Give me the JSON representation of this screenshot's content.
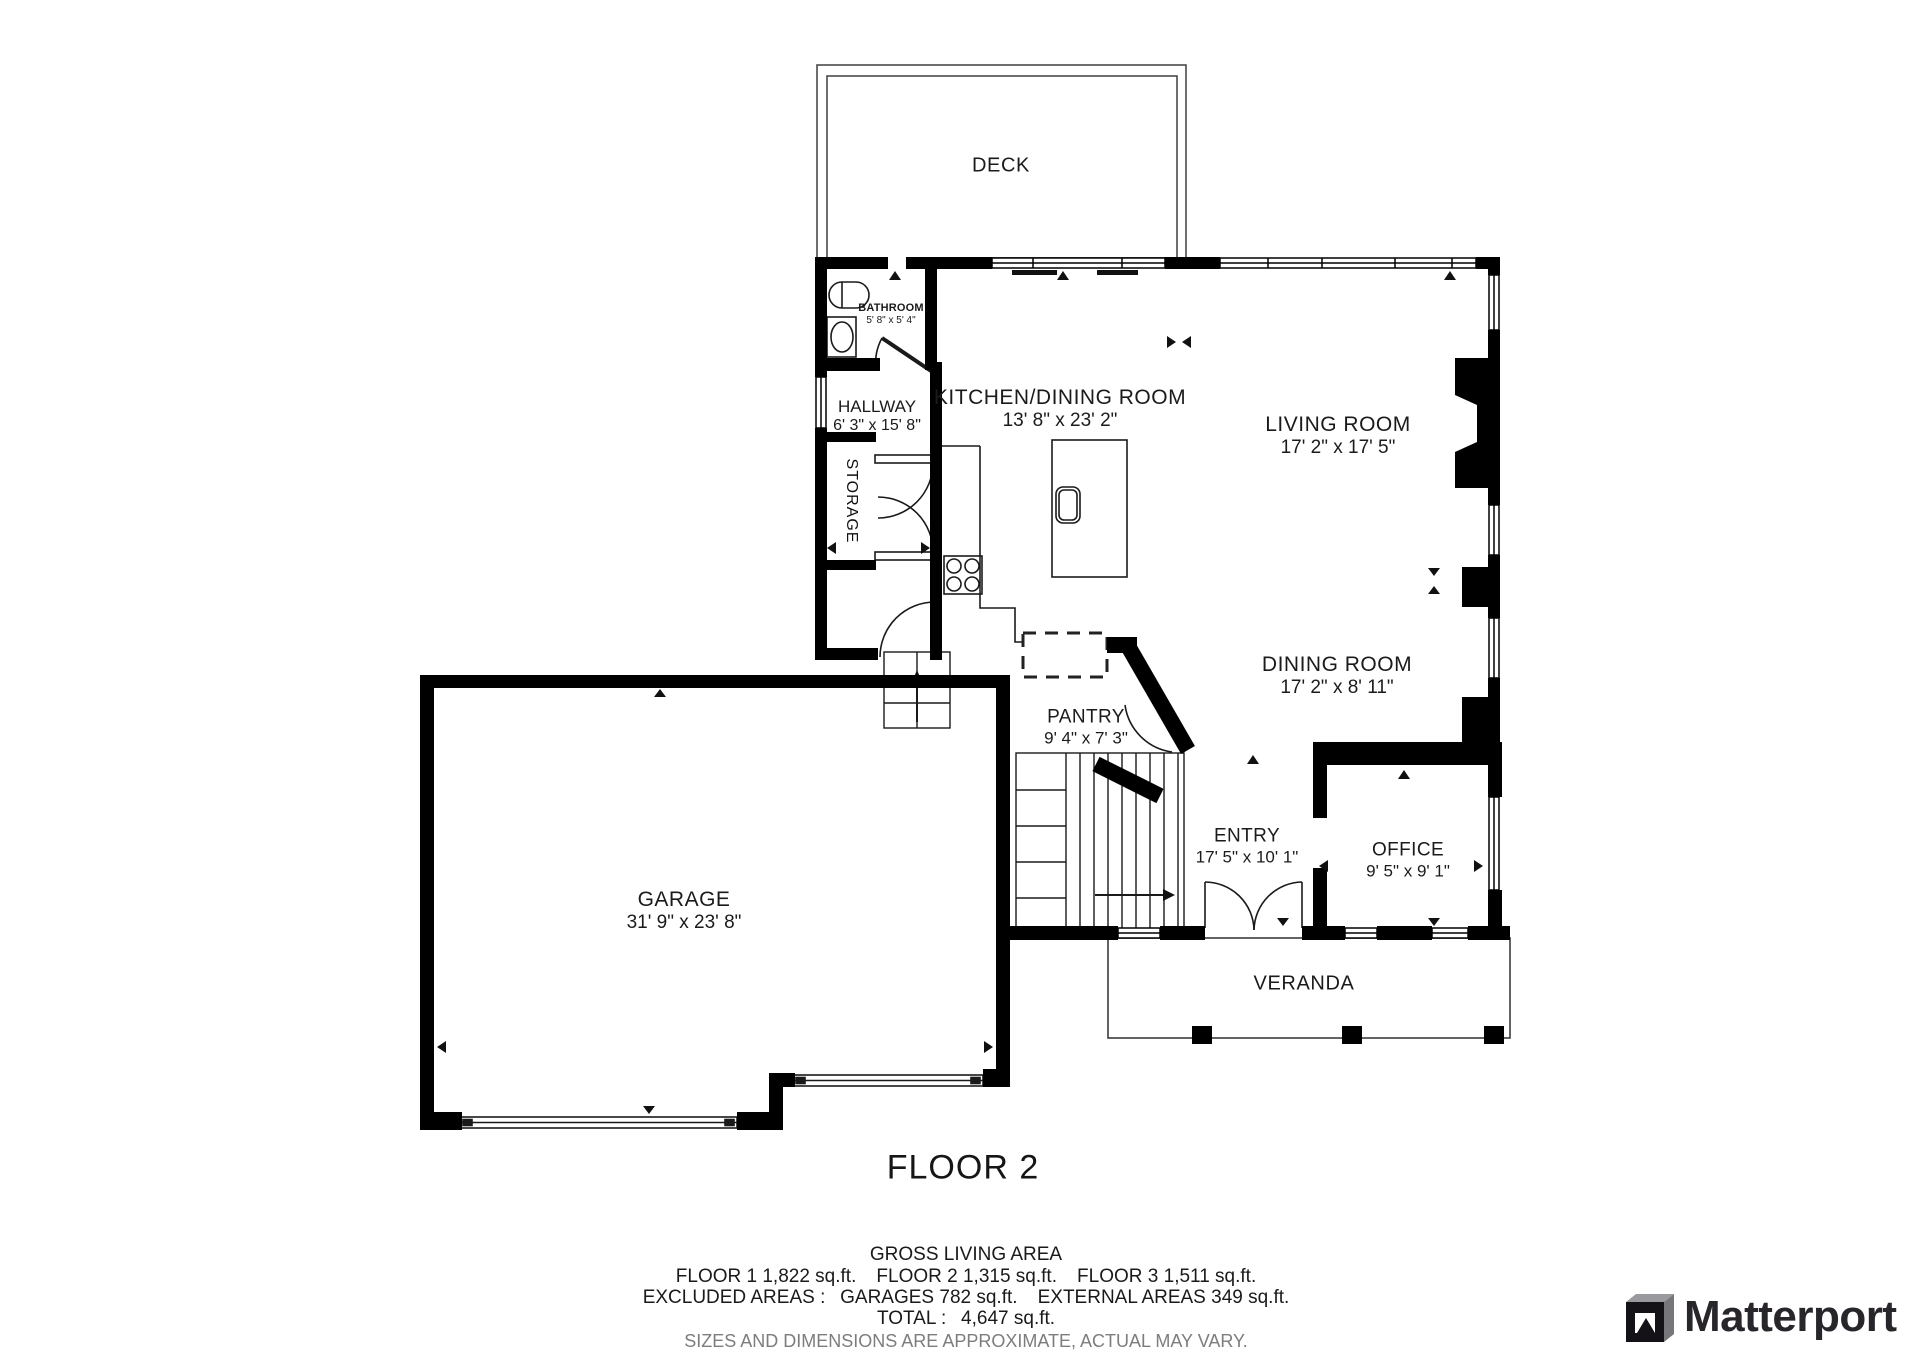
{
  "floorplan": {
    "title": "FLOOR 2",
    "rooms": {
      "deck": {
        "label": "DECK"
      },
      "bathroom": {
        "label": "BATHROOM",
        "dims": "5' 8\" x 5' 4\""
      },
      "hallway": {
        "label": "HALLWAY",
        "dims": "6' 3\" x 15' 8\""
      },
      "storage": {
        "label": "STORAGE"
      },
      "kitchen": {
        "label": "KITCHEN/DINING ROOM",
        "dims": "13' 8\" x 23' 2\""
      },
      "living": {
        "label": "LIVING ROOM",
        "dims": "17' 2\" x 17' 5\""
      },
      "dining": {
        "label": "DINING ROOM",
        "dims": "17' 2\" x 8' 11\""
      },
      "pantry": {
        "label": "PANTRY",
        "dims": "9' 4\" x 7' 3\""
      },
      "entry": {
        "label": "ENTRY",
        "dims": "17' 5\" x 10' 1\""
      },
      "office": {
        "label": "OFFICE",
        "dims": "9' 5\" x 9' 1\""
      },
      "garage": {
        "label": "GARAGE",
        "dims": "31' 9\" x 23' 8\""
      },
      "veranda": {
        "label": "VERANDA"
      }
    }
  },
  "footer": {
    "heading": "GROSS LIVING AREA",
    "floors_line": "FLOOR 1 1,822 sq.ft.   FLOOR 2 1,315 sq.ft.   FLOOR 3 1,511 sq.ft.",
    "excluded_line": "EXCLUDED AREAS :  GARAGES 782 sq.ft.   EXTERNAL AREAS 349 sq.ft.",
    "total_line": "TOTAL :  4,647 sq.ft.",
    "disclaimer": "SIZES AND DIMENSIONS ARE APPROXIMATE, ACTUAL MAY VARY."
  },
  "branding": {
    "logo_text": "Matterport"
  },
  "colors": {
    "wall": "#000000",
    "line": "#1a1a1a",
    "muted_text": "#7d7d7d",
    "brand_text": "#28252b"
  }
}
